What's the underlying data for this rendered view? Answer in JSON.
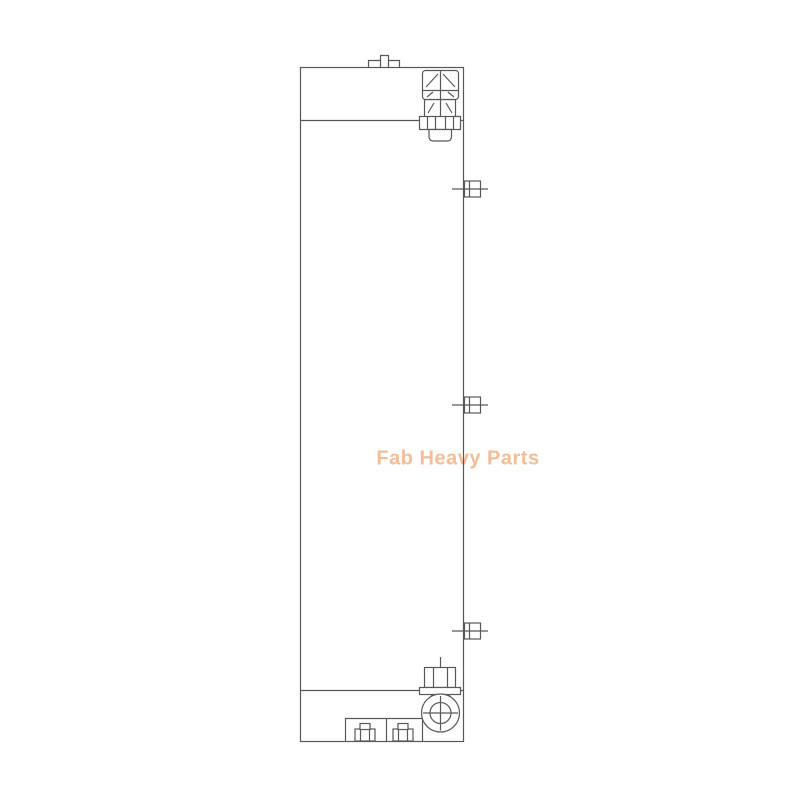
{
  "image": {
    "watermark_text": "Fab Heavy Parts"
  },
  "figure": {
    "type": "technical-line-drawing",
    "subject": "tall rectangular cooler core, front view",
    "components": [
      "core-body-outline",
      "top-tank-seam",
      "bottom-tank-seam",
      "top-mounting-tab",
      "top-filler-cap-fitting",
      "side-stud-upper",
      "side-stud-middle",
      "side-stud-lower",
      "bottom-plug-bolt",
      "bottom-port-circle",
      "bottom-mounting-bracket",
      "bracket-bolt-left",
      "bracket-bolt-right"
    ]
  },
  "theme": {
    "background": "#ffffff",
    "line-color": "#585858",
    "watermark-color": "#f4bd97"
  }
}
